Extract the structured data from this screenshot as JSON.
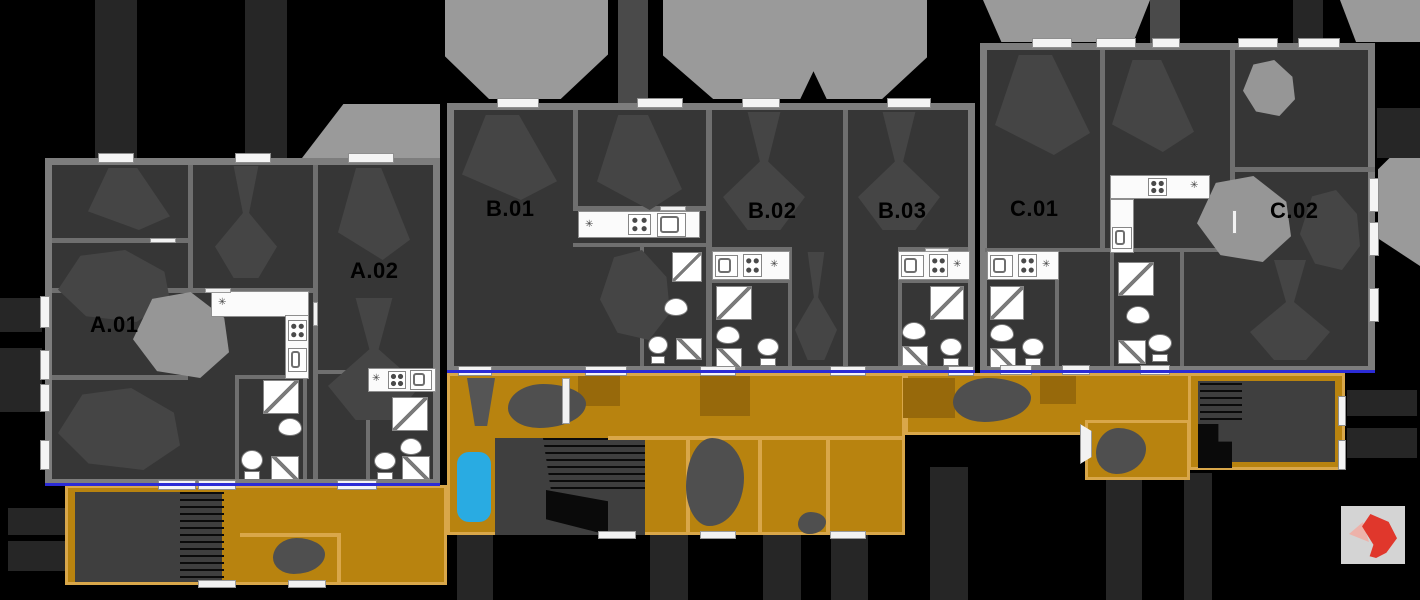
{
  "canvas": {
    "width": 1420,
    "height": 600,
    "background": "#000000"
  },
  "plan": {
    "title": "Apartment building floor plan",
    "units": [
      {
        "label": "A.01"
      },
      {
        "label": "A.02"
      },
      {
        "label": "B.01"
      },
      {
        "label": "B.02"
      },
      {
        "label": "B.03"
      },
      {
        "label": "C.01"
      },
      {
        "label": "C.02"
      }
    ],
    "icons": {
      "ceiling_light_glyph": "✳",
      "fixture_names": [
        "stove-hob-icon",
        "kitchen-sink-icon",
        "shower-icon",
        "toilet-icon",
        "washbasin-icon",
        "washing-machine-icon",
        "pool",
        "stairs-hatch",
        "tree"
      ]
    },
    "colors": {
      "deck": "#b8830f",
      "deck_frame": "#d9a74a",
      "wall": "#7d7d7d",
      "room_floor": "#363636",
      "partition": "#6f6f6f",
      "window": "#f4f4f4",
      "light_wedge": "#9a9a9a",
      "shadow_bar": "#262626",
      "furniture_shadow": "#454545",
      "highlight_blob": "#969696",
      "pool": "#29abe2",
      "threshold_line": "#2b2bd6",
      "tree": "#4f4f4f",
      "label_text": "#000000",
      "logo_bg": "#d4d4d4",
      "logo_red": "#e0372c"
    }
  }
}
